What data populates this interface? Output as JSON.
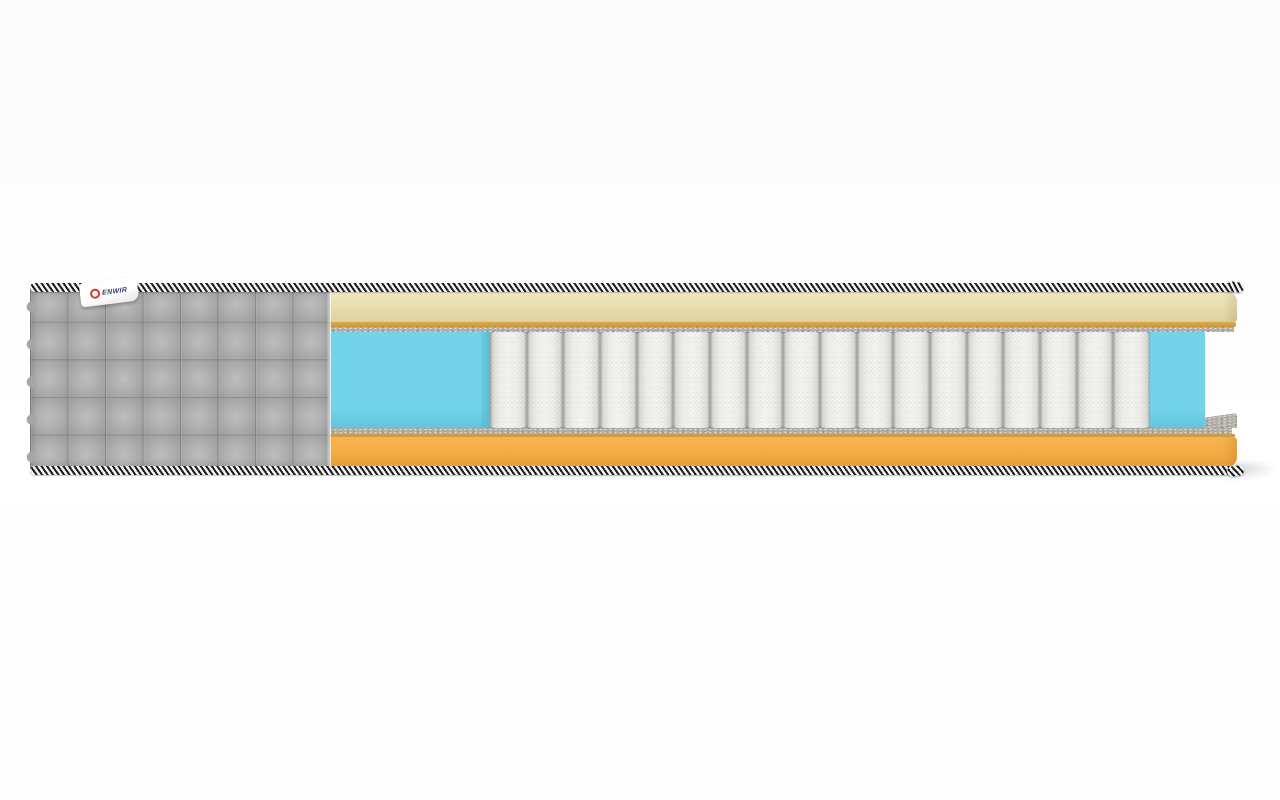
{
  "scene": {
    "type": "product-render",
    "subject": "mattress-cutaway-cross-section",
    "background": "plain white studio backdrop with soft floor shadow"
  },
  "brand_tag": {
    "text": "ENWIR",
    "icon": "red-ring-logo-icon"
  },
  "springs": {
    "count": 18
  },
  "layers": [
    {
      "name": "quilted-fabric-cover",
      "color": "#a8a8a8"
    },
    {
      "name": "binding-tape-striped",
      "colors": [
        "#1b1b1b",
        "#f2f2f2"
      ]
    },
    {
      "name": "top-comfort-foam",
      "color": "#e9dfb0"
    },
    {
      "name": "thin-glue-foam-sheet",
      "color": "#dcaa4e"
    },
    {
      "name": "felt-pad",
      "color": "#b2afa8"
    },
    {
      "name": "edge-support-foam",
      "color": "#74d3e8"
    },
    {
      "name": "pocket-spring-block",
      "color": "#f7f7f5"
    },
    {
      "name": "base-foam",
      "color": "#f3ab45"
    }
  ],
  "colors": {
    "cover": "#a8a8a8",
    "cover_hi": "#bdbdbd",
    "cover_lo": "#9a9a9a",
    "cream_light": "#f0e7c0",
    "cream": "#e9dfb0",
    "cream_dark": "#ddd19c",
    "tan": "#dcaa4e",
    "tan_dark": "#cf9c42",
    "felt": "#b2afa8",
    "cyan": "#74d3e8",
    "cyan_dark": "#57bcd4",
    "spring_light": "#f7f7f5",
    "spring_dark": "#a2a2a0",
    "orange_light": "#f7b352",
    "orange": "#f3ab45",
    "orange_dark": "#e89c35",
    "tape_dark": "#1b1b1b",
    "tape_light": "#f2f2f2",
    "tag_red": "#d8352a",
    "tag_text": "#333a66"
  }
}
